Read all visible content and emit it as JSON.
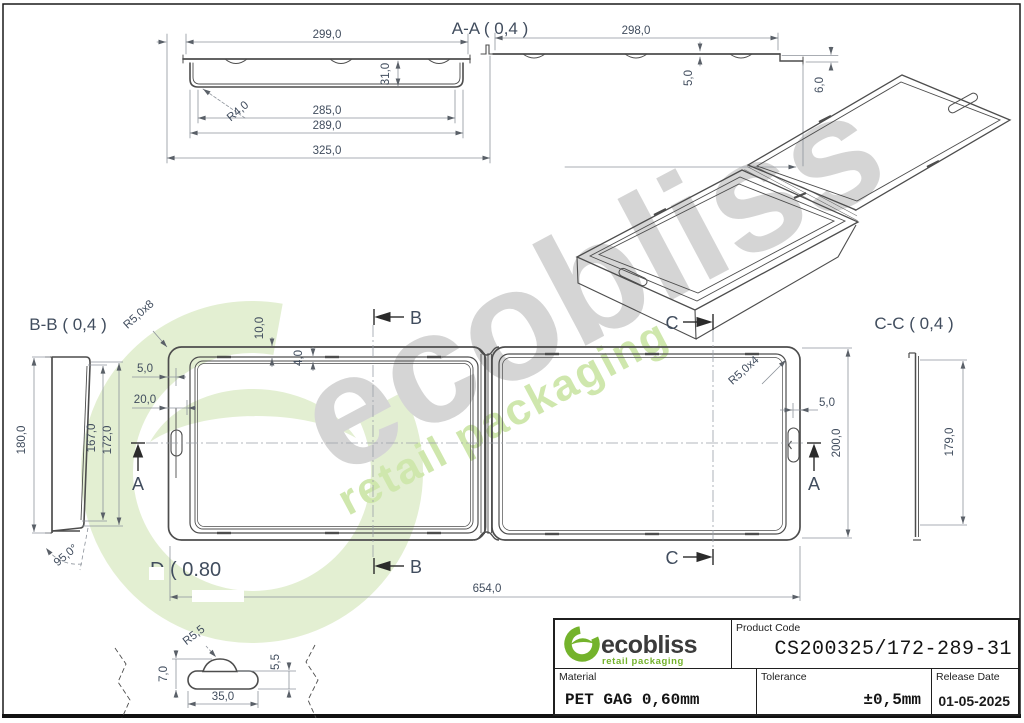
{
  "watermark": {
    "brand": "ecobliss",
    "tagline": "retail packaging"
  },
  "views": {
    "aa": {
      "title": "A-A ( 0,4 )",
      "d299": "299,0",
      "d298": "298,0",
      "d285": "285,0",
      "d289": "289,0",
      "d325": "325,0",
      "d31": "31,0",
      "r4": "R4,0",
      "d5": "5,0",
      "d6": "6,0"
    },
    "bb": {
      "title": "B-B ( 0,4 )",
      "d180": "180,0",
      "d167": "167,0",
      "d172": "172,0",
      "a95": "95,0°"
    },
    "cc": {
      "title": "C-C ( 0,4 )",
      "d179": "179,0"
    },
    "plan": {
      "r5x8": "R5,0x8",
      "r5x4": "R5,0x4",
      "d10": "10,0",
      "d4": "4,0",
      "d5_left": "5,0",
      "d20": "20,0",
      "d5_right": "5,0",
      "d200": "200,0",
      "d654": "654,0",
      "marker_a": "A",
      "marker_b": "B",
      "marker_c": "C"
    },
    "detail": {
      "title": "D ( 0.80",
      "r55": "R5,5",
      "d7": "7,0",
      "d55": "5,5",
      "d35": "35,0"
    }
  },
  "title_block": {
    "brand": "ecobliss",
    "brand_tagline": "retail packaging",
    "product_code_label": "Product Code",
    "product_code": "CS200325/172-289-31",
    "material_label": "Material",
    "material": "PET GAG 0,60mm",
    "tolerance_label": "Tolerance",
    "tolerance": "±0,5mm",
    "release_label": "Release Date",
    "release_date": "01-05-2025"
  },
  "colors": {
    "brand_green": "#74b32c",
    "watermark_green": "#e3efd2",
    "watermark_tagline_green": "#cfe7ad",
    "watermark_gray": "#d5d5d5",
    "line": "#4d4d4d",
    "dimension": "#8d939b",
    "dim_text": "#414d5e"
  }
}
